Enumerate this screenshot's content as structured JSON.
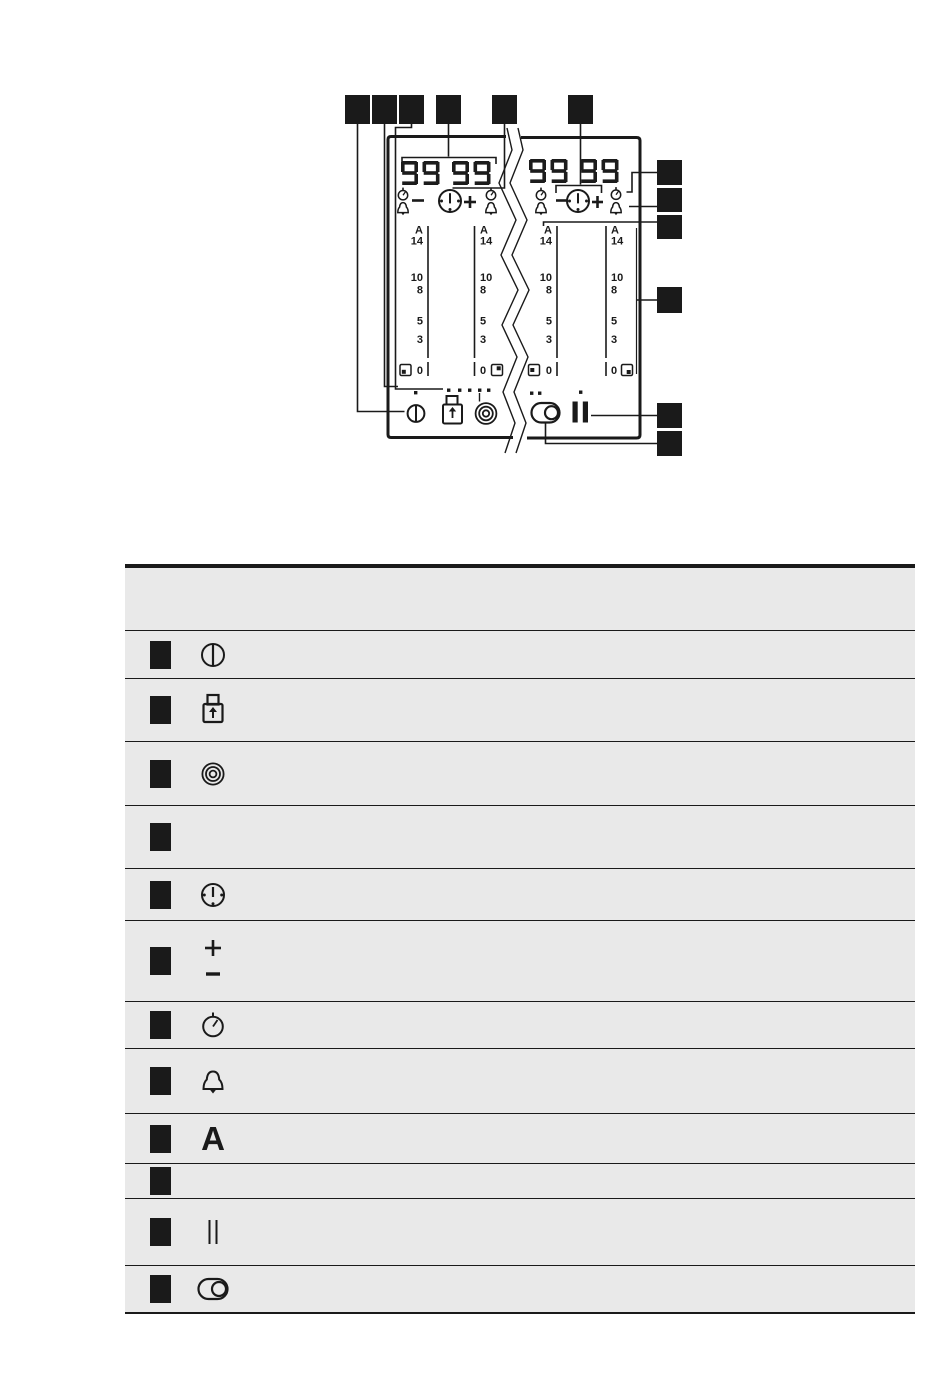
{
  "figure": {
    "name": "hob-control-panel-diagram",
    "displays": {
      "left": "99 99",
      "right": "99 99"
    },
    "scale_labels": [
      "A",
      "14",
      "10",
      "8",
      "5",
      "3",
      "0"
    ],
    "callout_markers": {
      "style": "solid-black-square",
      "color": "#1a1a1a",
      "top_row_count": 6,
      "right_column_count": 6
    },
    "icon_legend": [
      "power",
      "lock",
      "power-boost",
      "timer-display",
      "timer-clock",
      "plus-minus",
      "count-up-timer",
      "minute-minder-bell",
      "automatic-heat-up",
      "control-bar",
      "pause",
      "hob2hood"
    ]
  },
  "table": {
    "background": "#e9e9e9",
    "line_color": "#1a1a1a",
    "header": {
      "label": ""
    },
    "rows": [
      {
        "marker": "black-square",
        "icon": "power-icon",
        "symbol": ""
      },
      {
        "marker": "black-square",
        "icon": "lock-icon",
        "symbol": ""
      },
      {
        "marker": "black-square",
        "icon": "power-boost-icon",
        "symbol": ""
      },
      {
        "marker": "black-square",
        "icon": "",
        "symbol": ""
      },
      {
        "marker": "black-square",
        "icon": "timer-clock-icon",
        "symbol": ""
      },
      {
        "marker": "black-square",
        "icon": "plus-minus-icon",
        "symbol": ""
      },
      {
        "marker": "black-square",
        "icon": "count-up-timer-icon",
        "symbol": ""
      },
      {
        "marker": "black-square",
        "icon": "minute-minder-bell-icon",
        "symbol": ""
      },
      {
        "marker": "black-square",
        "icon": "letter-a",
        "symbol": "A"
      },
      {
        "marker": "black-square",
        "icon": "",
        "symbol": ""
      },
      {
        "marker": "black-square",
        "icon": "pause-icon",
        "symbol": ""
      },
      {
        "marker": "black-square",
        "icon": "hob2hood-icon",
        "symbol": ""
      }
    ]
  }
}
